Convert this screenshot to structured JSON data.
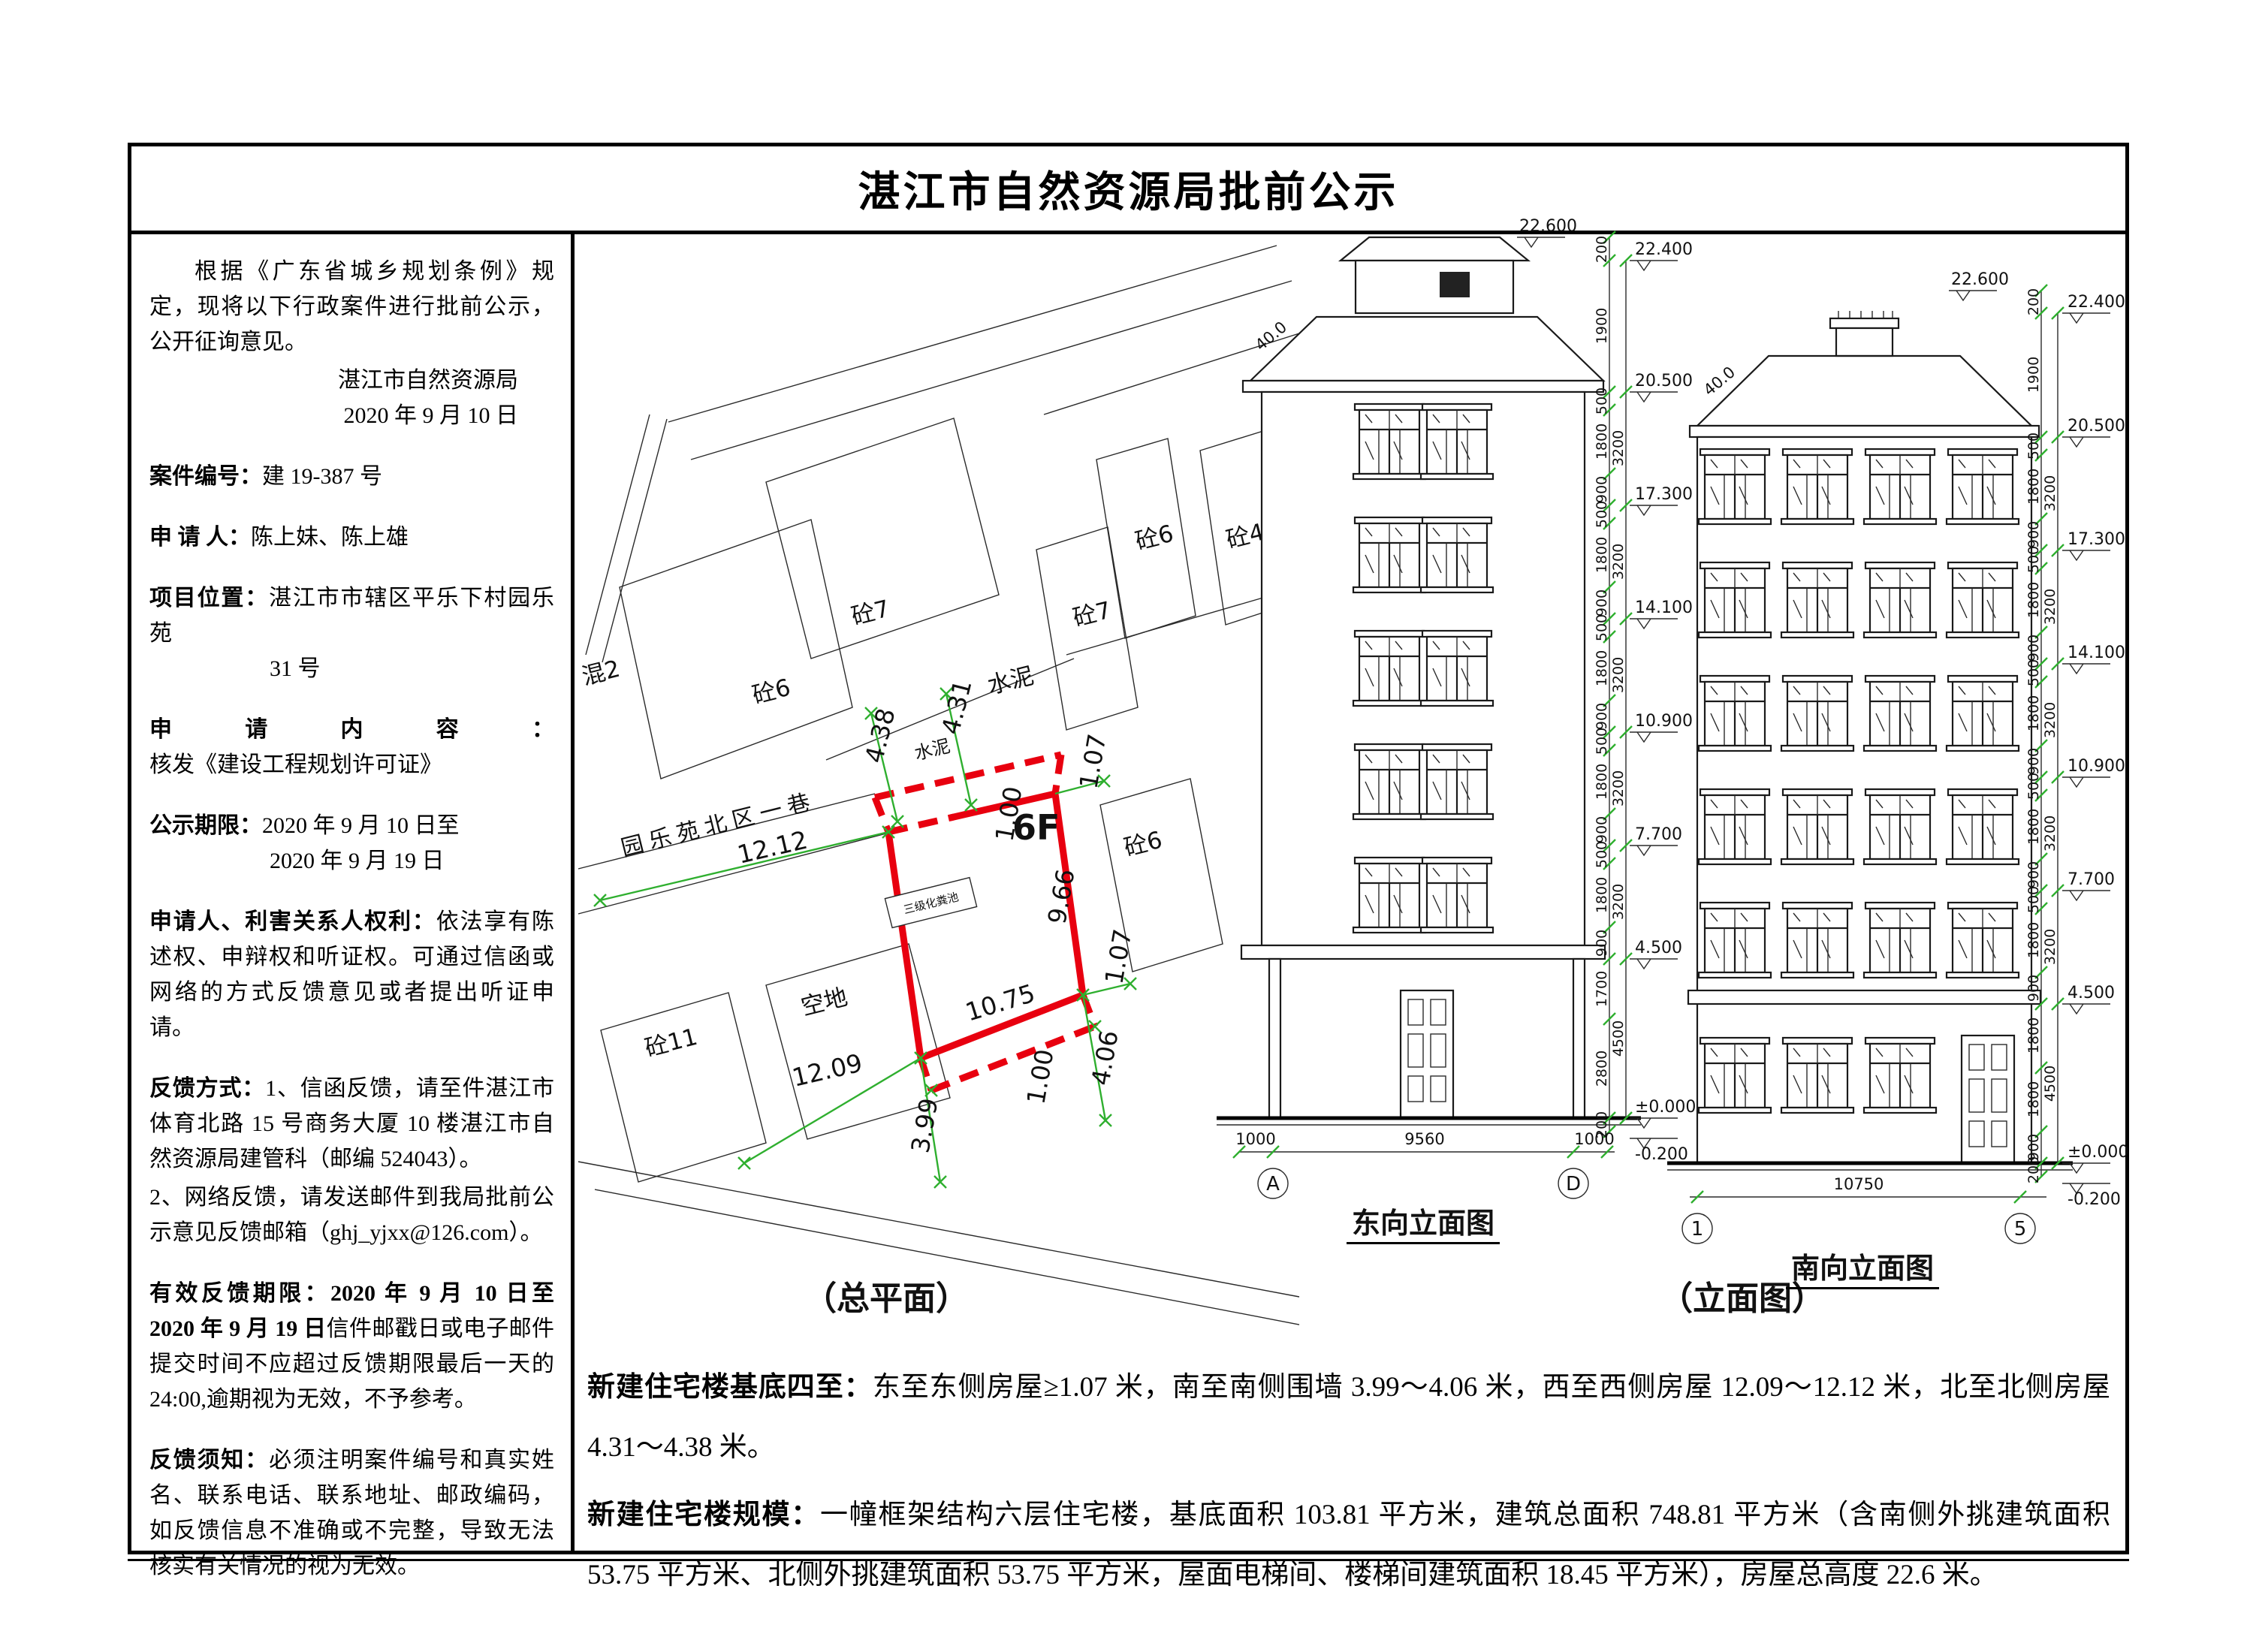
{
  "title": "湛江市自然资源局批前公示",
  "left": {
    "intro": "根据《广东省城乡规划条例》规定，现将以下行政案件进行批前公示，公开征询意见。",
    "agency": "湛江市自然资源局",
    "date": "2020 年 9 月 10 日",
    "case_label": "案件编号：",
    "case_no": "建 19-387 号",
    "applicant_label": "申  请  人：",
    "applicant": "陈上妹、陈上雄",
    "location_label": "项目位置：",
    "location": "湛江市市辖区平乐下村园乐苑",
    "location2": "31 号",
    "content_label": "申请内容：",
    "content": "核发《建设工程规划许可证》",
    "period_label": "公示期限：",
    "period1": "2020 年 9 月 10 日至",
    "period2": "2020 年 9 月 19 日",
    "rights_label": "申请人、利害关系人权利：",
    "rights": "依法享有陈述权、申辩权和听证权。可通过信函或网络的方式反馈意见或者提出听证申请。",
    "feedback_label": "反馈方式：",
    "feedback1": "1、信函反馈，请至件湛江市体育北路 15 号商务大厦 10 楼湛江市自然资源局建管科（邮编 524043）。",
    "feedback2": "2、网络反馈，请发送邮件到我局批前公示意见反馈邮箱（ghj_yjxx@126.com）。",
    "valid_label": "有效反馈期限：",
    "valid_bold": "2020 年 9 月 10 日至 2020 年 9 月 19 日",
    "valid": "信件邮戳日或电子邮件提交时间不应超过反馈期限最后一天的 24:00,逾期视为无效，不予参考。",
    "notice_label": "反馈须知：",
    "notice": "必须注明案件编号和真实姓名、联系电话、联系地址、邮政编码，如反馈信息不准确或不完整，导致无法核实有关情况的视为无效。"
  },
  "site": {
    "caption": "（总平面）",
    "labels": [
      "砼6",
      "砼7",
      "水泥",
      "砼7",
      "砼6",
      "砼4",
      "混2",
      "砼11",
      "空地",
      "砼6",
      "园乐苑北区一巷",
      "水泥",
      "三级化粪池",
      "6F"
    ],
    "dims": [
      "4.38",
      "4.31",
      "12.12",
      "12.09",
      "10.75",
      "9.66",
      "3.99",
      "4.06",
      "1.07",
      "1.07",
      "1.00",
      "1.00"
    ]
  },
  "elev": {
    "caption": "（立面图）",
    "east": {
      "title": "东向立面图",
      "slope": "40.0",
      "marks": [
        "22.600",
        "22.400",
        "20.500",
        "17.300",
        "14.100",
        "10.900",
        "7.700",
        "4.500",
        "±0.000",
        "-0.200"
      ],
      "inner": [
        "200",
        "1900",
        "500",
        "1800",
        "900",
        "500",
        "1800",
        "900",
        "500",
        "1800",
        "900",
        "500",
        "1800",
        "900",
        "500",
        "1800",
        "900",
        "1700",
        "2800",
        "200"
      ],
      "outer": [
        "3200",
        "3200",
        "3200",
        "3200",
        "3200",
        "4500"
      ],
      "axis": [
        "A",
        "D"
      ],
      "axis_dims": [
        "1000",
        "9560",
        "1000"
      ]
    },
    "south": {
      "title": "南向立面图",
      "slope": "40.0",
      "marks": [
        "22.600",
        "22.400",
        "20.500",
        "17.300",
        "14.100",
        "10.900",
        "7.700",
        "4.500",
        "±0.000",
        "-0.200"
      ],
      "inner": [
        "200",
        "1900",
        "500",
        "1800",
        "900",
        "500",
        "1800",
        "900",
        "500",
        "1800",
        "900",
        "500",
        "1800",
        "900",
        "500",
        "1800",
        "900",
        "1800",
        "1800",
        "900",
        "200"
      ],
      "outer": [
        "3200",
        "3200",
        "3200",
        "3200",
        "3200",
        "4500"
      ],
      "axis": [
        "1",
        "5"
      ],
      "axis_dims": [
        "10750"
      ]
    }
  },
  "bottom": {
    "p1_label": "新建住宅楼基底四至：",
    "p1": "东至东侧房屋≥1.07 米，南至南侧围墙 3.99～4.06 米，西至西侧房屋 12.09～12.12 米，北至北侧房屋 4.31～4.38 米。",
    "p2_label": "新建住宅楼规模：",
    "p2": "一幢框架结构六层住宅楼，基底面积 103.81 平方米，建筑总面积 748.81 平方米（含南侧外挑建筑面积 53.75 平方米、北侧外挑建筑面积 53.75 平方米，屋面电梯间、楼梯间建筑面积 18.45 平方米），房屋总高度 22.6 米。"
  }
}
